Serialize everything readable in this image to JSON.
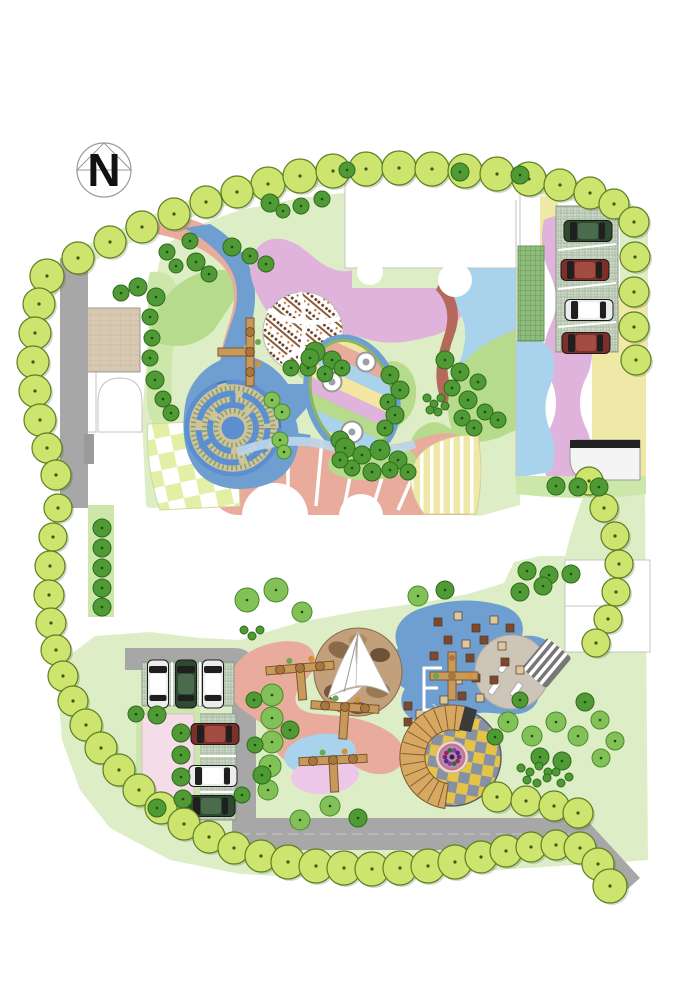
{
  "compass": {
    "label": "N"
  },
  "palette": {
    "lawn": "#ddeec6",
    "lawn2": "#cde7ab",
    "mound": "#b7db8c",
    "salmon": "#e9ab9b",
    "brick": "#b4695b",
    "blue": "#6f9fd0",
    "lblue": "#a9d2ec",
    "orchid": "#dfb3dc",
    "payellow": "#efe8a6",
    "road": "#a7a7a7",
    "treebig": "#cde46e",
    "treebigline": "#5d7f22",
    "treedark": "#4f9a35",
    "treedarkline": "#2f6b1d",
    "treemid": "#82c157",
    "treemidline": "#4a8a2a",
    "tan": "#d7c9b2",
    "parkbg": "#ccd7c6",
    "parkline": "#9db49a",
    "gridgreen": "#8fbc7c",
    "checkY": "#e2efa5",
    "targetY": "#e5c346",
    "targetG": "#8791a6",
    "wood": "#d8a761",
    "woodline": "#7a5a30",
    "pinkplaza": "#f4dce8",
    "sand": "#c2a07b",
    "violet2": "#ecc7e8"
  },
  "cars": [
    {
      "x": 588,
      "y": 231,
      "rot": 0,
      "color": "green"
    },
    {
      "x": 585,
      "y": 270,
      "rot": 0,
      "color": "red"
    },
    {
      "x": 589,
      "y": 310,
      "rot": 0,
      "color": "white"
    },
    {
      "x": 586,
      "y": 343,
      "rot": 0,
      "color": "red"
    },
    {
      "x": 158,
      "y": 684,
      "rot": 90,
      "color": "white"
    },
    {
      "x": 186,
      "y": 684,
      "rot": 90,
      "color": "green"
    },
    {
      "x": 213,
      "y": 684,
      "rot": 90,
      "color": "white"
    },
    {
      "x": 215,
      "y": 734,
      "rot": 0,
      "color": "red"
    },
    {
      "x": 213,
      "y": 776,
      "rot": 0,
      "color": "white"
    },
    {
      "x": 211,
      "y": 806,
      "rot": 0,
      "color": "green"
    }
  ],
  "car_colors": {
    "white": {
      "body": "#ececec",
      "roof": "#ffffff"
    },
    "green": {
      "body": "#2e4a30",
      "roof": "#4a6b4c"
    },
    "red": {
      "body": "#7e2f2a",
      "roof": "#a34c43"
    }
  },
  "trees": {
    "big": [
      [
        268,
        184,
        17
      ],
      [
        300,
        176,
        17
      ],
      [
        333,
        171,
        17
      ],
      [
        366,
        169,
        17
      ],
      [
        399,
        168,
        17
      ],
      [
        432,
        169,
        17
      ],
      [
        465,
        171,
        17
      ],
      [
        497,
        174,
        17
      ],
      [
        529,
        179,
        17
      ],
      [
        560,
        185,
        16
      ],
      [
        590,
        193,
        16
      ],
      [
        614,
        204,
        15
      ],
      [
        237,
        192,
        16
      ],
      [
        206,
        202,
        16
      ],
      [
        174,
        214,
        16
      ],
      [
        142,
        227,
        16
      ],
      [
        110,
        242,
        16
      ],
      [
        78,
        258,
        16
      ],
      [
        47,
        276,
        17
      ],
      [
        39,
        304,
        16
      ],
      [
        35,
        333,
        16
      ],
      [
        33,
        362,
        16
      ],
      [
        35,
        391,
        16
      ],
      [
        40,
        420,
        16
      ],
      [
        47,
        448,
        15
      ],
      [
        56,
        475,
        15
      ],
      [
        58,
        508,
        14
      ],
      [
        53,
        537,
        14
      ],
      [
        50,
        566,
        15
      ],
      [
        49,
        595,
        15
      ],
      [
        51,
        623,
        15
      ],
      [
        56,
        650,
        15
      ],
      [
        63,
        676,
        15
      ],
      [
        73,
        701,
        15
      ],
      [
        86,
        725,
        16
      ],
      [
        101,
        748,
        16
      ],
      [
        119,
        770,
        16
      ],
      [
        139,
        790,
        16
      ],
      [
        161,
        808,
        16
      ],
      [
        184,
        824,
        16
      ],
      [
        209,
        837,
        16
      ],
      [
        234,
        848,
        16
      ],
      [
        261,
        856,
        16
      ],
      [
        288,
        862,
        17
      ],
      [
        316,
        866,
        17
      ],
      [
        344,
        868,
        17
      ],
      [
        372,
        869,
        17
      ],
      [
        400,
        868,
        17
      ],
      [
        428,
        866,
        17
      ],
      [
        455,
        862,
        17
      ],
      [
        481,
        857,
        16
      ],
      [
        506,
        851,
        16
      ],
      [
        531,
        847,
        15
      ],
      [
        556,
        845,
        15
      ],
      [
        580,
        848,
        16
      ],
      [
        598,
        864,
        16
      ],
      [
        610,
        886,
        17
      ],
      [
        497,
        797,
        15
      ],
      [
        526,
        801,
        15
      ],
      [
        554,
        806,
        15
      ],
      [
        578,
        813,
        15
      ],
      [
        634,
        222,
        15
      ],
      [
        635,
        257,
        15
      ],
      [
        634,
        292,
        15
      ],
      [
        634,
        327,
        15
      ],
      [
        636,
        360,
        15
      ],
      [
        589,
        481,
        14
      ],
      [
        604,
        508,
        14
      ],
      [
        615,
        536,
        14
      ],
      [
        619,
        564,
        14
      ],
      [
        616,
        592,
        14
      ],
      [
        608,
        619,
        14
      ],
      [
        596,
        643,
        14
      ]
    ],
    "small": [
      [
        138,
        287,
        9,
        "d"
      ],
      [
        156,
        297,
        9,
        "d"
      ],
      [
        121,
        293,
        8,
        "d"
      ],
      [
        150,
        317,
        8,
        "d"
      ],
      [
        152,
        338,
        8,
        "d"
      ],
      [
        150,
        358,
        8,
        "d"
      ],
      [
        155,
        380,
        9,
        "d"
      ],
      [
        163,
        399,
        8,
        "d"
      ],
      [
        171,
        413,
        8,
        "d"
      ],
      [
        270,
        203,
        9,
        "d"
      ],
      [
        283,
        211,
        7,
        "d"
      ],
      [
        347,
        170,
        8,
        "d"
      ],
      [
        460,
        172,
        9,
        "d"
      ],
      [
        520,
        175,
        9,
        "d"
      ],
      [
        301,
        206,
        8,
        "d"
      ],
      [
        322,
        199,
        8,
        "d"
      ],
      [
        232,
        247,
        9,
        "d"
      ],
      [
        250,
        256,
        8,
        "d"
      ],
      [
        266,
        264,
        8,
        "d"
      ],
      [
        167,
        252,
        8,
        "d"
      ],
      [
        176,
        266,
        7,
        "d"
      ],
      [
        190,
        241,
        8,
        "d"
      ],
      [
        196,
        262,
        9,
        "d"
      ],
      [
        209,
        274,
        8,
        "d"
      ],
      [
        315,
        352,
        10,
        "d"
      ],
      [
        332,
        360,
        9,
        "d"
      ],
      [
        308,
        368,
        8,
        "d"
      ],
      [
        325,
        374,
        8,
        "d"
      ],
      [
        342,
        368,
        8,
        "d"
      ],
      [
        291,
        368,
        8,
        "d"
      ],
      [
        310,
        358,
        9,
        "d"
      ],
      [
        390,
        375,
        9,
        "d"
      ],
      [
        400,
        390,
        9,
        "d"
      ],
      [
        388,
        402,
        8,
        "d"
      ],
      [
        395,
        415,
        9,
        "d"
      ],
      [
        385,
        428,
        8,
        "d"
      ],
      [
        340,
        440,
        9,
        "d"
      ],
      [
        345,
        448,
        10,
        "d"
      ],
      [
        362,
        455,
        9,
        "d"
      ],
      [
        380,
        450,
        10,
        "d"
      ],
      [
        398,
        460,
        9,
        "d"
      ],
      [
        352,
        468,
        8,
        "d"
      ],
      [
        372,
        472,
        9,
        "d"
      ],
      [
        390,
        470,
        8,
        "d"
      ],
      [
        408,
        472,
        8,
        "d"
      ],
      [
        340,
        460,
        8,
        "d"
      ],
      [
        445,
        360,
        9,
        "d"
      ],
      [
        460,
        372,
        9,
        "d"
      ],
      [
        452,
        388,
        8,
        "d"
      ],
      [
        468,
        400,
        9,
        "d"
      ],
      [
        478,
        382,
        8,
        "d"
      ],
      [
        485,
        412,
        8,
        "d"
      ],
      [
        462,
        418,
        8,
        "d"
      ],
      [
        474,
        428,
        8,
        "d"
      ],
      [
        498,
        420,
        8,
        "d"
      ],
      [
        272,
        400,
        8,
        "m"
      ],
      [
        282,
        412,
        8,
        "m"
      ],
      [
        280,
        440,
        8,
        "m"
      ],
      [
        284,
        452,
        7,
        "m"
      ],
      [
        427,
        398,
        4,
        "d"
      ],
      [
        434,
        404,
        4,
        "d"
      ],
      [
        441,
        398,
        4,
        "d"
      ],
      [
        430,
        410,
        4,
        "d"
      ],
      [
        438,
        412,
        4,
        "d"
      ],
      [
        445,
        406,
        4,
        "d"
      ],
      [
        527,
        571,
        9,
        "d"
      ],
      [
        549,
        575,
        9,
        "d"
      ],
      [
        571,
        574,
        9,
        "d"
      ],
      [
        556,
        486,
        9,
        "d"
      ],
      [
        578,
        487,
        9,
        "d"
      ],
      [
        599,
        487,
        9,
        "d"
      ],
      [
        102,
        528,
        9,
        "d"
      ],
      [
        102,
        548,
        9,
        "d"
      ],
      [
        102,
        568,
        9,
        "d"
      ],
      [
        102,
        588,
        9,
        "d"
      ],
      [
        102,
        607,
        9,
        "d"
      ],
      [
        136,
        714,
        8,
        "d"
      ],
      [
        157,
        715,
        9,
        "d"
      ],
      [
        181,
        733,
        9,
        "d"
      ],
      [
        181,
        755,
        9,
        "d"
      ],
      [
        181,
        777,
        9,
        "d"
      ],
      [
        183,
        799,
        9,
        "d"
      ],
      [
        157,
        808,
        9,
        "d"
      ],
      [
        247,
        600,
        12,
        "m"
      ],
      [
        276,
        590,
        12,
        "m"
      ],
      [
        302,
        612,
        10,
        "m"
      ],
      [
        418,
        596,
        10,
        "m"
      ],
      [
        445,
        590,
        9,
        "d"
      ],
      [
        520,
        592,
        9,
        "d"
      ],
      [
        543,
        586,
        9,
        "d"
      ],
      [
        272,
        695,
        11,
        "m"
      ],
      [
        272,
        718,
        11,
        "m"
      ],
      [
        272,
        742,
        11,
        "m"
      ],
      [
        270,
        766,
        11,
        "m"
      ],
      [
        268,
        790,
        10,
        "m"
      ],
      [
        254,
        700,
        8,
        "d"
      ],
      [
        290,
        730,
        9,
        "d"
      ],
      [
        255,
        745,
        8,
        "d"
      ],
      [
        262,
        775,
        9,
        "d"
      ],
      [
        242,
        795,
        8,
        "d"
      ],
      [
        300,
        820,
        10,
        "m"
      ],
      [
        330,
        806,
        10,
        "m"
      ],
      [
        358,
        818,
        9,
        "d"
      ],
      [
        508,
        722,
        10,
        "m"
      ],
      [
        532,
        736,
        10,
        "m"
      ],
      [
        556,
        722,
        10,
        "m"
      ],
      [
        578,
        736,
        10,
        "m"
      ],
      [
        540,
        757,
        9,
        "d"
      ],
      [
        562,
        761,
        9,
        "d"
      ],
      [
        585,
        702,
        9,
        "d"
      ],
      [
        600,
        720,
        9,
        "m"
      ],
      [
        520,
        700,
        8,
        "d"
      ],
      [
        495,
        737,
        8,
        "d"
      ],
      [
        601,
        758,
        9,
        "m"
      ],
      [
        615,
        741,
        9,
        "m"
      ],
      [
        521,
        768,
        4,
        "d"
      ],
      [
        530,
        772,
        4,
        "d"
      ],
      [
        539,
        766,
        4,
        "d"
      ],
      [
        548,
        772,
        4,
        "d"
      ],
      [
        527,
        780,
        4,
        "d"
      ],
      [
        537,
        783,
        4,
        "d"
      ],
      [
        547,
        778,
        4,
        "d"
      ],
      [
        556,
        772,
        4,
        "d"
      ],
      [
        561,
        783,
        4,
        "d"
      ],
      [
        569,
        777,
        4,
        "d"
      ],
      [
        244,
        630,
        4,
        "d"
      ],
      [
        252,
        636,
        4,
        "d"
      ],
      [
        260,
        630,
        4,
        "d"
      ]
    ]
  }
}
